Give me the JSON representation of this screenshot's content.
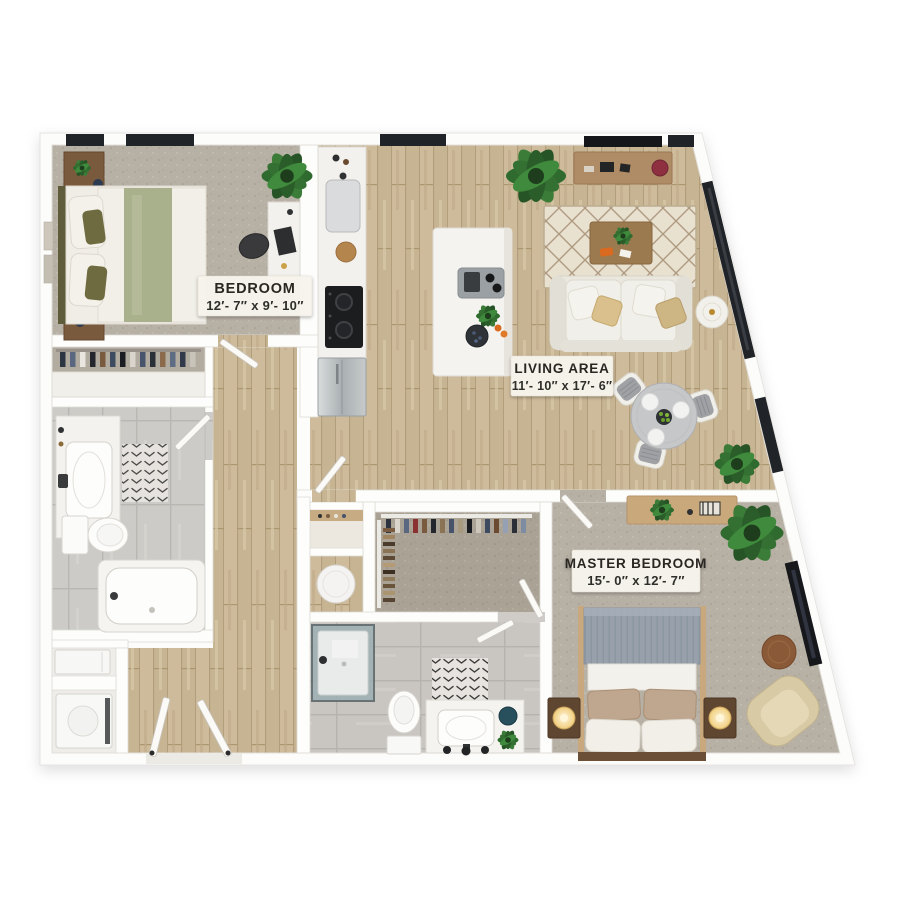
{
  "image_type": "3d-apartment-floor-plan",
  "rooms": {
    "bedroom": {
      "name": "BEDROOM",
      "dimensions": "12′- 7″ x 9′- 10″"
    },
    "living_area": {
      "name": "LIVING AREA",
      "dimensions": "11′- 10″ x 17′- 6″"
    },
    "master_bedroom": {
      "name": "MASTER BEDROOM",
      "dimensions": "15′- 0″ x 12′- 7″"
    }
  },
  "palette": {
    "background": "#ffffff",
    "walls": "#fdfdfc",
    "wood_floor": "#c7b492",
    "carpet": "#b7b0a5",
    "closet_carpet": "#a9a295",
    "tile": "#cdcbc7",
    "window_glass": "#202327",
    "sage_bedding": "#a9b08c",
    "master_blanket": "#98a1ab",
    "plant_green": "#2f6b2e",
    "label_plate": "#f8f5ee",
    "label_text": "#29282４"
  }
}
